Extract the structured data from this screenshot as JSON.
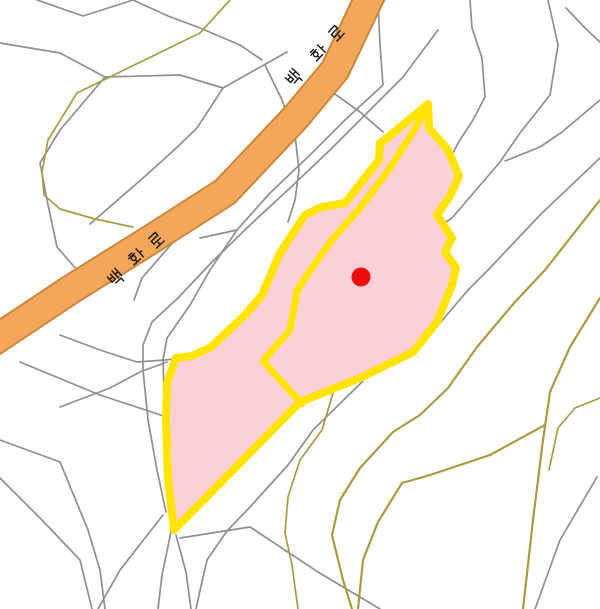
{
  "map": {
    "kind": "cadastral parcel map",
    "background": "#FFFFFF",
    "road": {
      "label": "백화로",
      "fill_color": "#F4A65A",
      "casing_color": "#C8883C",
      "label_color": "#1A1A1A"
    },
    "highlight_parcel": {
      "fill_color": "#FAD0D6",
      "outline_color": "#FFE400",
      "outline_width": 8
    },
    "marker": {
      "shape": "dot",
      "color": "#EE0D0D",
      "x": 361,
      "y": 277,
      "radius": 9.5
    },
    "lines": {
      "parcel_boundary_color": "#8F8F8F",
      "contour_color": "#A89B44"
    }
  }
}
